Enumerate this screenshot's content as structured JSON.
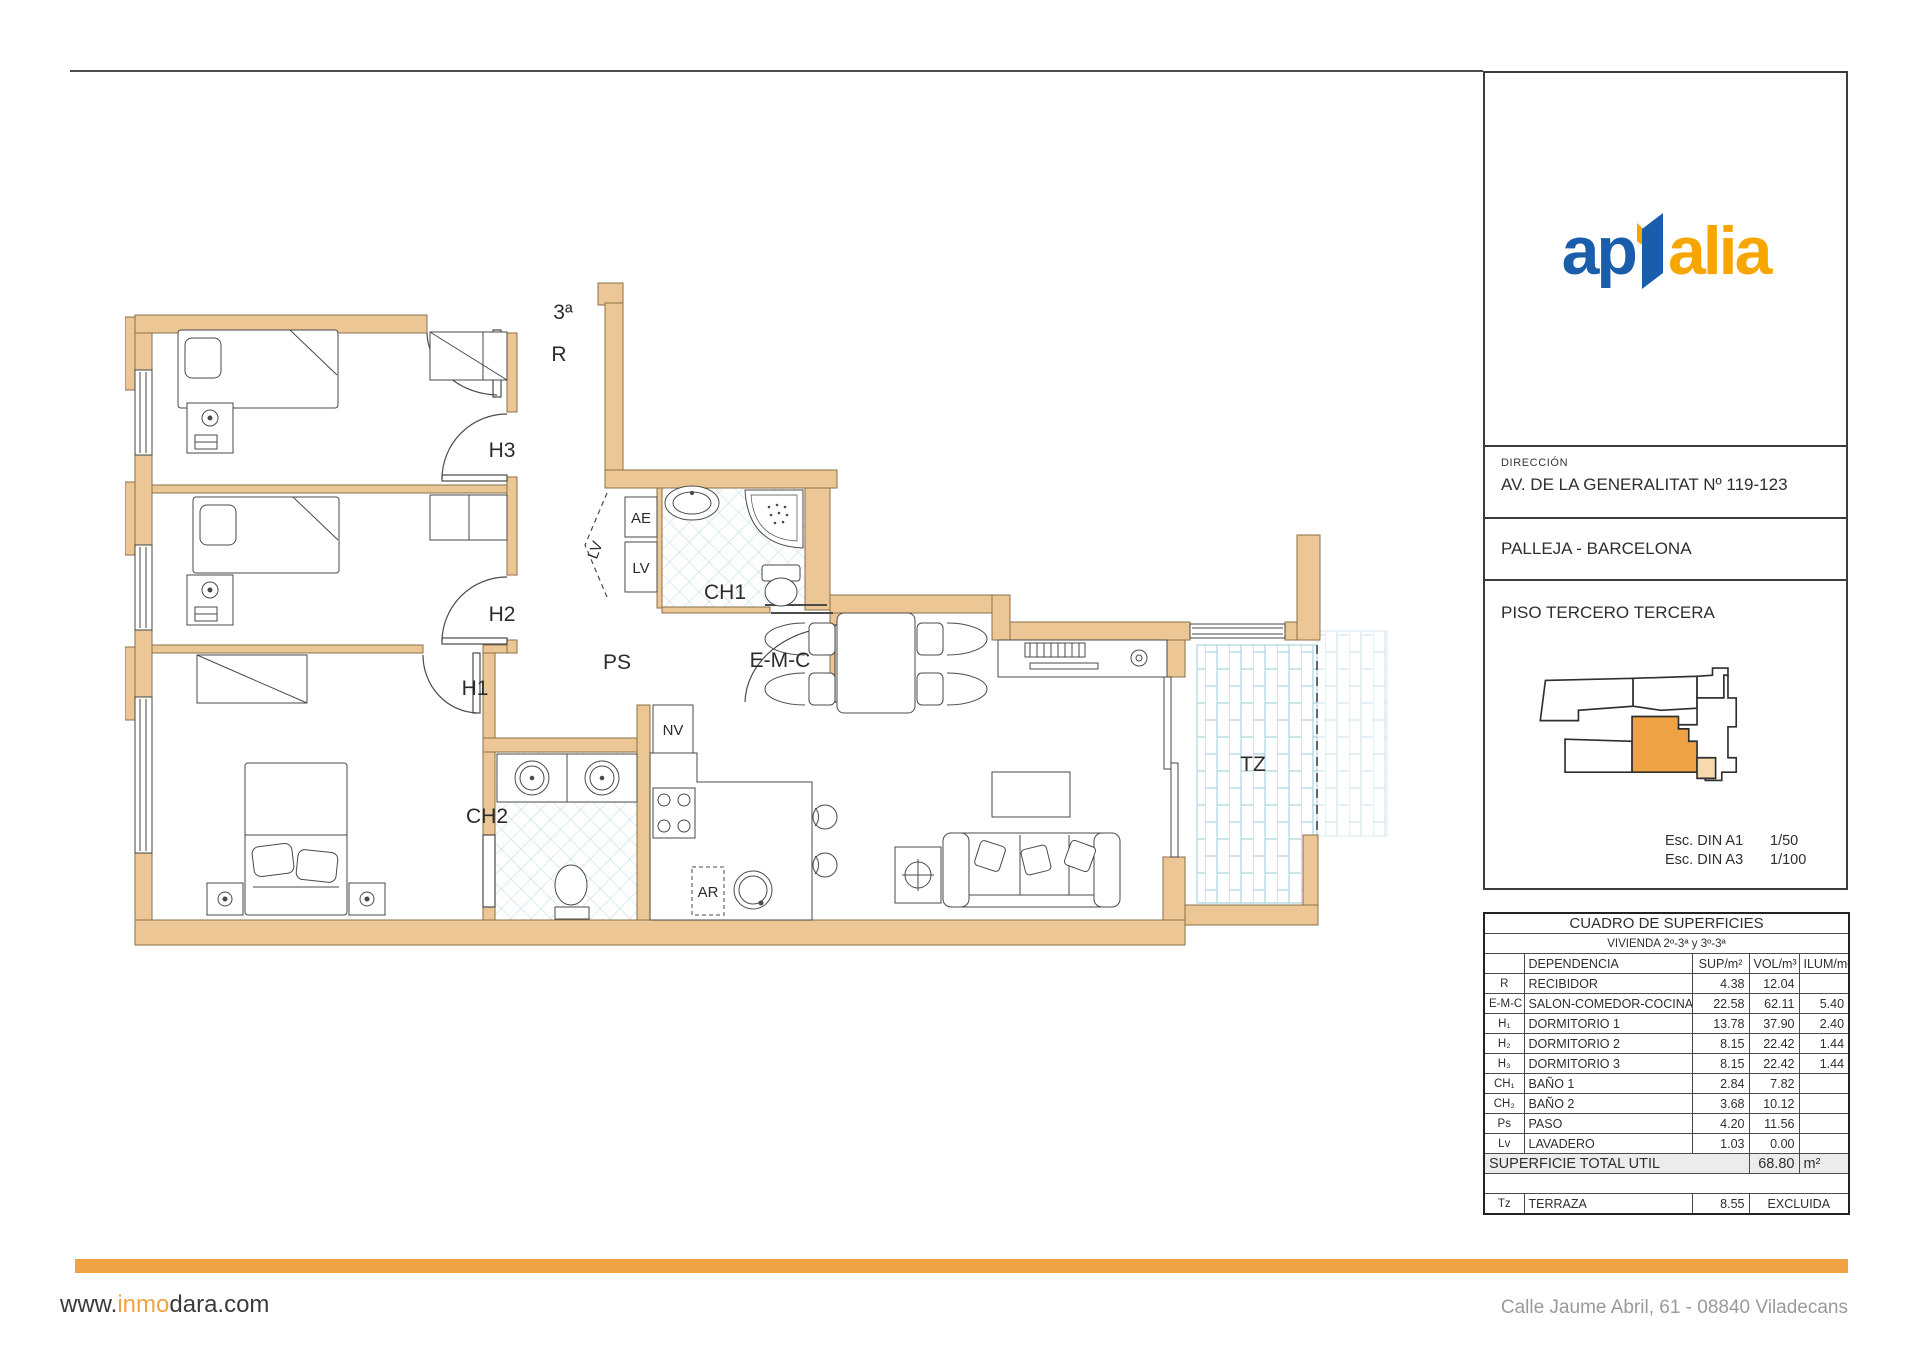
{
  "colors": {
    "accent": "#efa243",
    "logo_blue": "#1a5dab",
    "logo_orange": "#f7a600",
    "wall": "#ecc795",
    "wall_stroke": "#8a7048",
    "tile_line": "#b9dbe6",
    "brick_line": "#9ecbd8",
    "map_unit_pale": "#f8d9ae"
  },
  "plan": {
    "labels": {
      "entrance": "3ª",
      "recibidor": "R",
      "h3": "H3",
      "h2": "H2",
      "h1": "H1",
      "ps": "PS",
      "ae": "AE",
      "lv_box": "LV",
      "lv_door": "LV",
      "ch1": "CH1",
      "ch2": "CH2",
      "nv": "NV",
      "ar": "AR",
      "emc": "E-M-C",
      "tz": "TZ"
    }
  },
  "panel": {
    "logo": {
      "left": "ap",
      "right": "alia"
    },
    "direccion_label": "DIRECCIÓN",
    "address": "AV. DE LA GENERALITAT Nº 119-123",
    "city": "PALLEJA - BARCELONA",
    "floor": "PISO TERCERO TERCERA",
    "scales": [
      {
        "label": "Esc. DIN A1",
        "value": "1/50"
      },
      {
        "label": "Esc. DIN A3",
        "value": "1/100"
      }
    ]
  },
  "surfaces": {
    "title": "CUADRO DE SUPERFICIES",
    "subtitle": "VIVIENDA 2º-3ª y 3º-3ª",
    "headers": [
      "",
      "DEPENDENCIA",
      "SUP/m²",
      "VOL/m³",
      "ILUM/m²"
    ],
    "rows": [
      [
        "R",
        "RECIBIDOR",
        "4.38",
        "12.04",
        ""
      ],
      [
        "E-M-C",
        "SALON-COMEDOR-COCINA",
        "22.58",
        "62.11",
        "5.40"
      ],
      [
        "H₁",
        "DORMITORIO 1",
        "13.78",
        "37.90",
        "2.40"
      ],
      [
        "H₂",
        "DORMITORIO 2",
        "8.15",
        "22.42",
        "1.44"
      ],
      [
        "H₃",
        "DORMITORIO 3",
        "8.15",
        "22.42",
        "1.44"
      ],
      [
        "CH₁",
        "BAÑO 1",
        "2.84",
        "7.82",
        ""
      ],
      [
        "CH₂",
        "BAÑO 2",
        "3.68",
        "10.12",
        ""
      ],
      [
        "Ps",
        "PASO",
        "4.20",
        "11.56",
        ""
      ],
      [
        "Lv",
        "LAVADERO",
        "1.03",
        "0.00",
        ""
      ]
    ],
    "total": {
      "label": "SUPERFICIE TOTAL UTIL",
      "value": "68.80",
      "unit": "m²"
    },
    "excluded": {
      "code": "Tz",
      "name": "TERRAZA",
      "sup": "8.55",
      "note": "EXCLUIDA"
    }
  },
  "footer": {
    "url_prefix": "www.",
    "url_highlight": "inmo",
    "url_suffix": "dara.com",
    "address": "Calle Jaume Abril, 61 - 08840 Viladecans"
  }
}
